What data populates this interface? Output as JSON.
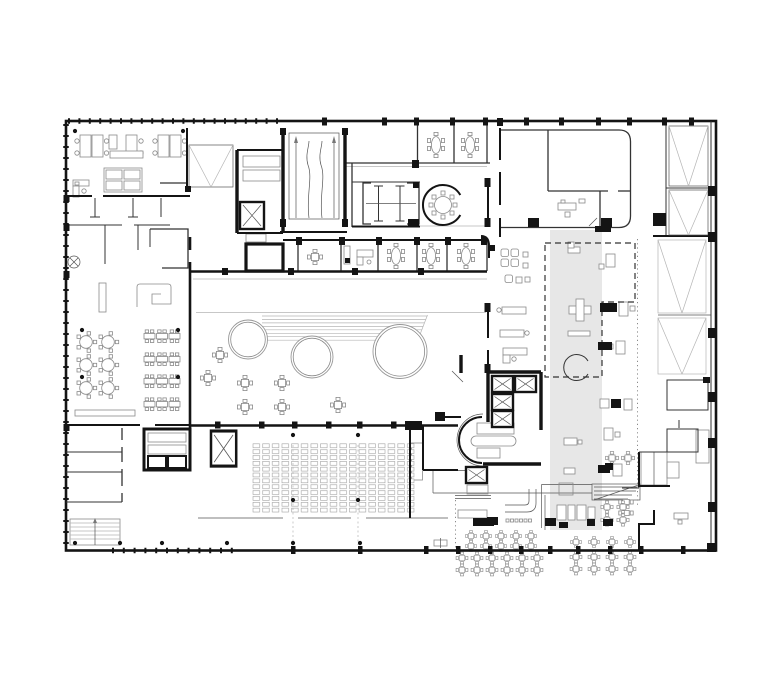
{
  "meta": {
    "label": "Architectural ground floor plan drawing, black line work on white background",
    "kind": "technical-floor-plan",
    "visible_text": "none"
  },
  "canvas": {
    "width": 780,
    "height": 680,
    "background": "#ffffff"
  },
  "palette": {
    "paper": "#ffffff",
    "wall": "#141414",
    "line": "#333333",
    "mid": "#555555",
    "thin": "#8a8a8a",
    "faint": "#b5b5b5",
    "shade": "#e7e7e7"
  },
  "zones": [
    {
      "id": "open-office-northwest",
      "label": "open plan office with desks and sofa group"
    },
    {
      "id": "cellular-offices-west",
      "label": "small cellular rooms"
    },
    {
      "id": "skylight-void",
      "label": "rectangular void with V brace lines"
    },
    {
      "id": "stair-elevator-core-north",
      "label": "stair flights and elevator shaft"
    },
    {
      "id": "ramp-hall",
      "label": "ramp hall with up arrows"
    },
    {
      "id": "wc-block",
      "label": "toilet block with stall partitions"
    },
    {
      "id": "round-meeting-room",
      "label": "circular meeting room, round table, 8 chairs"
    },
    {
      "id": "meeting-rooms",
      "label": "row of meeting rooms with oval tables"
    },
    {
      "id": "canteen",
      "label": "canteen: 6 round tables, 4 rows of long tables"
    },
    {
      "id": "atrium",
      "label": "atrium with stepped seating lines and three circular voids"
    },
    {
      "id": "lounge",
      "label": "lounge with four armchairs"
    },
    {
      "id": "gallery-strip",
      "label": "shaded double height strip with dashed outline, plus-shaped table, broken circle"
    },
    {
      "id": "east-facade-strip",
      "label": "service strip with V braced panels"
    },
    {
      "id": "auditorium",
      "label": "auditorium seat grid"
    },
    {
      "id": "central-core",
      "label": "five elevator cars, curved wall, stairs"
    },
    {
      "id": "cafe",
      "label": "cafe with counters, kitchen block, tables"
    },
    {
      "id": "terrace",
      "label": "outdoor terrace table clusters"
    }
  ],
  "counts": {
    "atrium_circles": 3,
    "auditorium_seat_columns": 17,
    "auditorium_seat_rows": 12,
    "canteen_round_tables": 6,
    "canteen_long_table_rows": 4,
    "elevator_cars_total": 8,
    "atrium_small_tables": 7,
    "terrace_clusters": 2
  }
}
